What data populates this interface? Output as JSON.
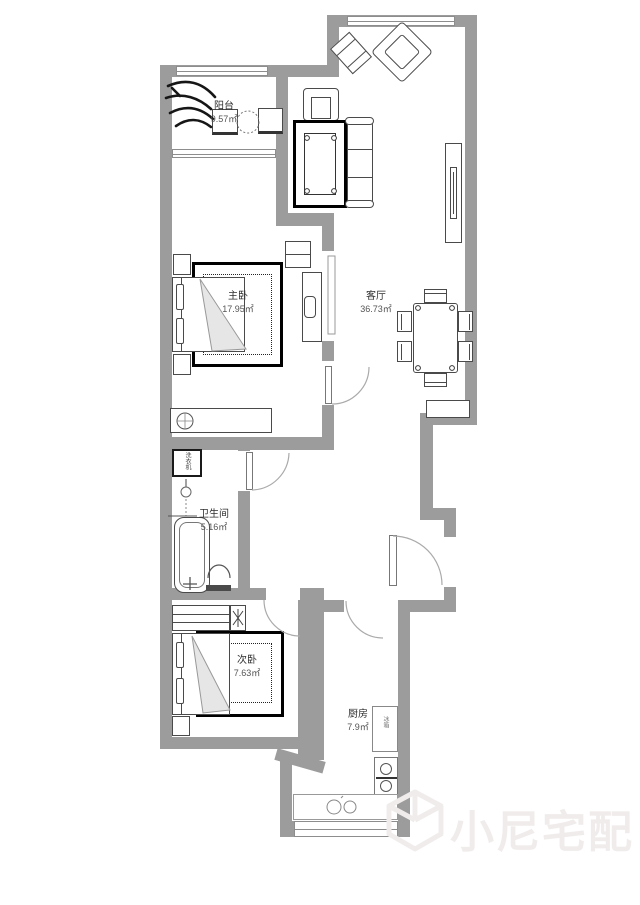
{
  "plan_title": "apartment-floor-plan",
  "rooms": {
    "balcony": {
      "name": "阳台",
      "area": "9.57㎡"
    },
    "master_bedroom": {
      "name": "主卧",
      "area": "17.95㎡"
    },
    "living_room": {
      "name": "客厅",
      "area": "36.73㎡"
    },
    "bathroom": {
      "name": "卫生间",
      "area": "5.16㎡"
    },
    "second_bedroom": {
      "name": "次卧",
      "area": "7.63㎡"
    },
    "kitchen": {
      "name": "厨房",
      "area": "7.9㎡"
    }
  },
  "appliances": {
    "washing_machine": "洗衣机",
    "fridge": "冰箱"
  },
  "watermark": {
    "brand": "小尼宅配"
  },
  "colors": {
    "wall": "#9c9c9c",
    "furniture_line": "#4a4a4a",
    "rug_border": "#000000",
    "watermark": "#f1ecec",
    "background": "#ffffff"
  }
}
